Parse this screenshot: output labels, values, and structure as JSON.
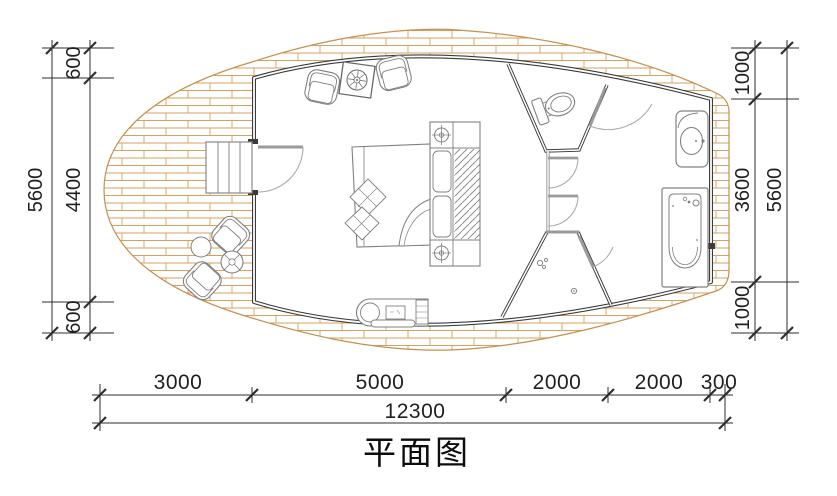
{
  "title": {
    "text": "平面图"
  },
  "dimensions": {
    "left": {
      "segments": [
        "600",
        "4400",
        "600"
      ],
      "total": "5600"
    },
    "right": {
      "segments": [
        "1000",
        "3600",
        "1000"
      ],
      "total": "5600"
    },
    "bottom": {
      "segments": [
        "3000",
        "5000",
        "2000",
        "2000",
        "300"
      ],
      "total": "12300"
    }
  },
  "colors": {
    "wall": "#3b3b3b",
    "furniture": "#808080",
    "door": "#9b9b9b",
    "brick_hatch": "#d6a05e",
    "deck_edge": "#c6904e",
    "dimension": "#2e2e2e"
  },
  "fixtures": [
    "entry-stairs",
    "entry-door",
    "indoor-armchairs",
    "plant-table",
    "double-bed",
    "headboard-cabinet",
    "bedside-lamps",
    "chaise-lounge",
    "outdoor-chairs",
    "outdoor-round-table",
    "toilet",
    "washbasin",
    "bathtub",
    "shower",
    "floor-drain",
    "brick-deck"
  ]
}
